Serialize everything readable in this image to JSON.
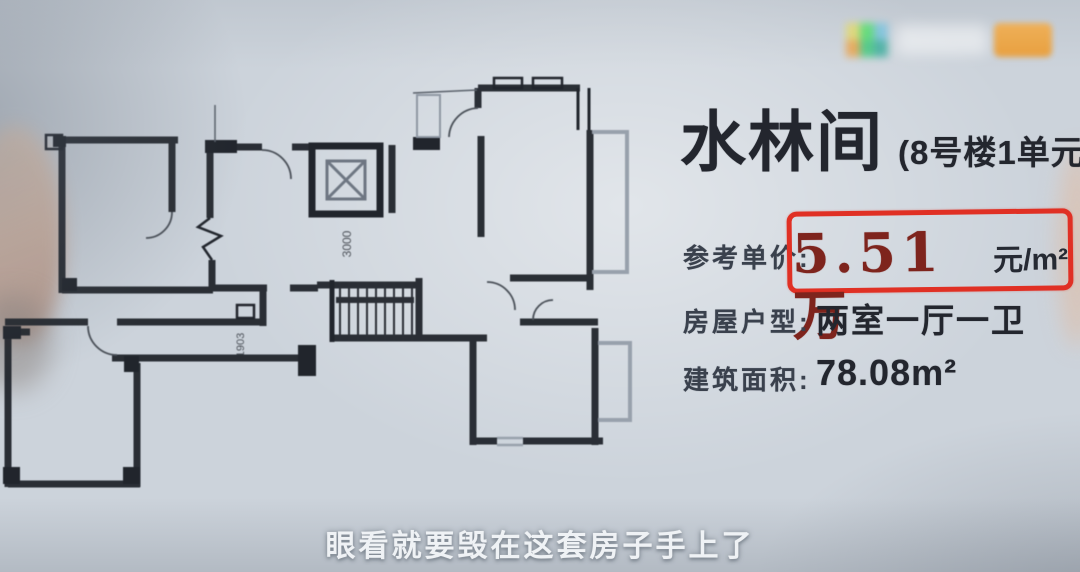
{
  "listing": {
    "title": "水林间",
    "unit_info": "(8号楼1单元1802",
    "rows": {
      "price": {
        "label": "参考单价:",
        "value": "5.51万",
        "unit": "元/m²"
      },
      "layout": {
        "label": "房屋户型:",
        "value": "两室一厅一卫"
      },
      "area": {
        "label": "建筑面积:",
        "value": "78.08m²"
      }
    },
    "highlight_box_color": "#e03024",
    "price_text_color": "#7e241d"
  },
  "floor_plan": {
    "dimension_labels": [
      "3000",
      "1903"
    ],
    "wall_color": "#21252c",
    "balcony_color": "#98a1ac"
  },
  "watermark": {
    "logo_colors": [
      "#e2d96e",
      "#55dd6e",
      "#7ac3de",
      "#eba44b",
      "#43c97e",
      "#3fae9f"
    ],
    "badge_color": "#f0a43c"
  },
  "video": {
    "subtitle": "眼看就要毁在这套房子手上了"
  }
}
